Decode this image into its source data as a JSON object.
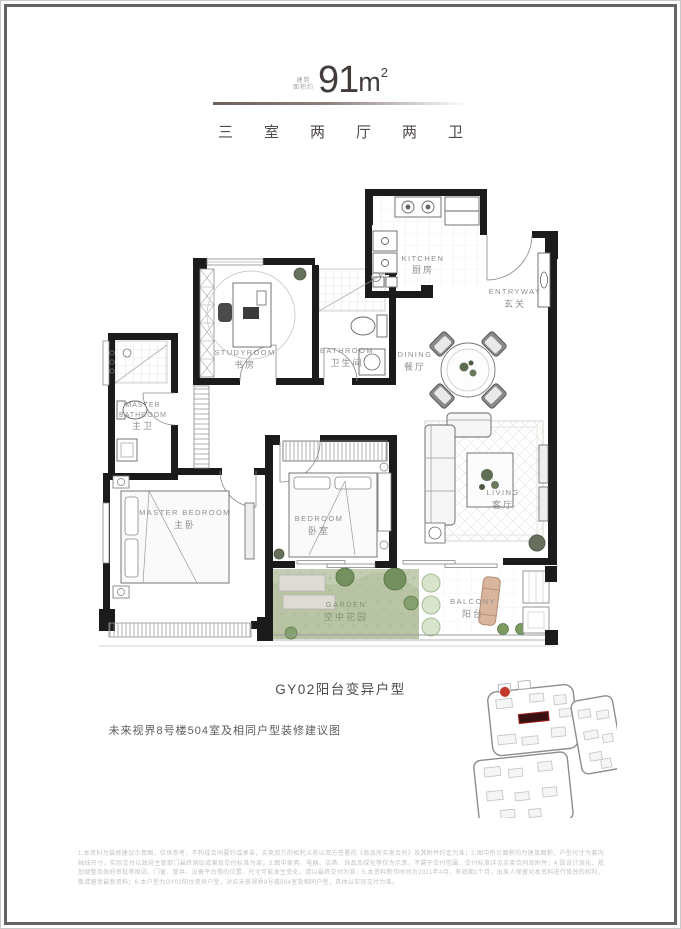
{
  "header": {
    "area_label_line1": "建筑",
    "area_label_line2": "面积约",
    "area_value": "91",
    "area_unit": "m",
    "area_unit_exp": "2",
    "layout_summary": "三室两厅两卫"
  },
  "plan": {
    "rooms": {
      "kitchen": {
        "en": "KITCHEN",
        "zh": "厨房"
      },
      "entryway": {
        "en": "ENTRYWAY",
        "zh": "玄关"
      },
      "studyroom": {
        "en": "STUDYROOM",
        "zh": "书房"
      },
      "bathroom": {
        "en": "BATHROOM",
        "zh": "卫生间"
      },
      "master_bathroom": {
        "en_line1": "MASTER",
        "en_line2": "BATHROOM",
        "zh": "主卫"
      },
      "dining": {
        "en": "DINING",
        "zh": "餐厅"
      },
      "living": {
        "en": "LIVING",
        "zh": "客厅"
      },
      "master_bedroom": {
        "en": "MASTER BEDROOM",
        "zh": "主卧"
      },
      "bedroom": {
        "en": "BEDROOM",
        "zh": "卧室"
      },
      "garden": {
        "en": "GARDEN",
        "zh": "空中花园"
      },
      "balcony": {
        "en": "BALCONY",
        "zh": "阳台"
      }
    }
  },
  "captions": {
    "unit_code": "GY02阳台变异户型",
    "project_note": "未来视界8号楼504室及相同户型装修建议图"
  },
  "disclaimer": {
    "text": "1.本资料为装修建议示意图，仅供参考，不构成合同要约或承诺，买卖双方的权利义务以双方签署的《商品房买卖合同》及其附件约定为准；2.图中所示面积均为建筑面积，户型尺寸为套内轴线尺寸，实际交付以政府主管部门最终测绘成果及交付标准为准；3.图中家具、电器、洁具、饰品及绿化等仅为示意，不属于交付范围，交付标准详见买卖合同及附件；4.因设计深化、规划调整及政府审批等原因，门窗、管井、设备平台等的位置、尺寸可能发生变化，请以最终交付为准；5.本资料制作时间为2021年4月，有效期1个月，出卖人保留对本资料进行修改的权利，敬请留意最新资料；6.本户型为GY02阳台变异户型，对应未来视界8号楼504室及相同户型，具体以实际交付为准。"
  },
  "colors": {
    "wall": "#1b1b1b",
    "accent_red": "#c0392b",
    "garden_green": "#c3cdb2",
    "shrub_green": "#73905e",
    "lounger_tan": "#d9b59e"
  }
}
